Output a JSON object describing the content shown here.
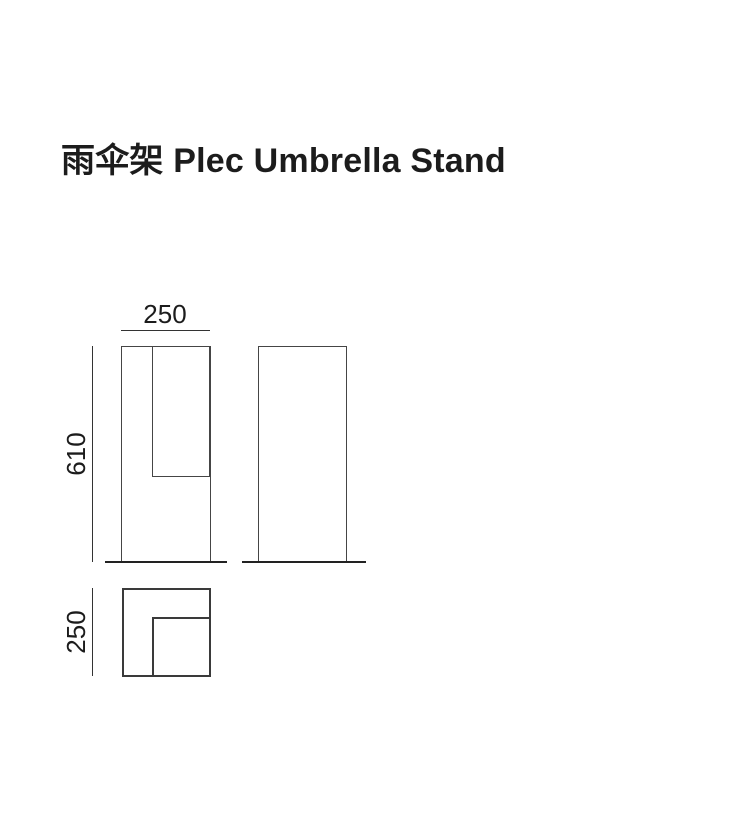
{
  "title": "雨伞架 Plec Umbrella Stand",
  "product": {
    "name_cn": "雨伞架",
    "name_en": "Plec Umbrella Stand"
  },
  "diagram": {
    "type": "orthographic-projection-drawing",
    "dimensions_mm": {
      "width": 250,
      "height": 610,
      "depth": 250
    },
    "labels": {
      "width": "250",
      "height": "610",
      "depth": "250"
    }
  },
  "colors": {
    "background": "#ffffff",
    "text": "#1c1c1c",
    "outline": "#454545",
    "plan_outline": "#3a3a3a",
    "ground": "#222222",
    "dim_line": "#333333"
  }
}
